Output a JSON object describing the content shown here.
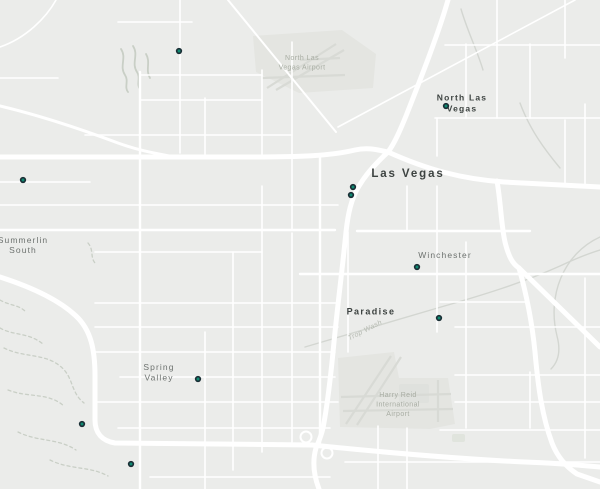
{
  "map": {
    "colors": {
      "background": "#ebecea",
      "road": "#ffffff",
      "airport_fill": "#e4e5e1",
      "runway": "#d8dad5",
      "terminal": "#dfe1dd",
      "green_patch": "#e0e4dd",
      "wash": "#c9cfc6",
      "wash_light": "#d3d6d1",
      "trail": "#c9cfc6",
      "marker_fill": "#108a72",
      "marker_stroke": "#1b2f36",
      "label_city": "#3d4341",
      "label_district": "#6d726f",
      "label_airport": "#a8ada3",
      "label_wash": "#b5bab1"
    },
    "labels": [
      {
        "id": "las-vegas",
        "lines": [
          "Las Vegas"
        ],
        "x": 408,
        "y": 177,
        "lh": 12,
        "style": "city-large"
      },
      {
        "id": "north-las-vegas",
        "lines": [
          "North Las",
          "Vegas"
        ],
        "x": 462,
        "y": 100.5,
        "lh": 10.8,
        "style": "city-medium"
      },
      {
        "id": "paradise",
        "lines": [
          "Paradise"
        ],
        "x": 371,
        "y": 314.5,
        "lh": 11,
        "style": "city-small"
      },
      {
        "id": "winchester",
        "lines": [
          "Winchester"
        ],
        "x": 445,
        "y": 258,
        "lh": 10,
        "style": "district"
      },
      {
        "id": "summerlin-south",
        "lines": [
          "Summerlin",
          "South"
        ],
        "x": 23,
        "y": 243,
        "lh": 10,
        "style": "district"
      },
      {
        "id": "spring-valley",
        "lines": [
          "Spring",
          "Valley"
        ],
        "x": 159,
        "y": 370,
        "lh": 10.5,
        "style": "district"
      },
      {
        "id": "north-las-vegas-airport",
        "lines": [
          "North Las",
          "Vegas Airport"
        ],
        "x": 302,
        "y": 60,
        "lh": 9.5,
        "style": "airport"
      },
      {
        "id": "harry-reid-airport",
        "lines": [
          "Harry Reid",
          "International",
          "Airport"
        ],
        "x": 398,
        "y": 397,
        "lh": 9.5,
        "style": "airport"
      },
      {
        "id": "trop-wash",
        "lines": [
          "Trop Wash"
        ],
        "x": 366,
        "y": 332,
        "lh": 9,
        "style": "wash",
        "rotate": -27
      }
    ],
    "markers": [
      {
        "x": 179,
        "y": 51
      },
      {
        "x": 446,
        "y": 106
      },
      {
        "x": 23,
        "y": 180
      },
      {
        "x": 353,
        "y": 187
      },
      {
        "x": 351,
        "y": 195
      },
      {
        "x": 417,
        "y": 267
      },
      {
        "x": 439,
        "y": 318
      },
      {
        "x": 198,
        "y": 379
      },
      {
        "x": 82,
        "y": 424
      },
      {
        "x": 131,
        "y": 464
      }
    ]
  }
}
